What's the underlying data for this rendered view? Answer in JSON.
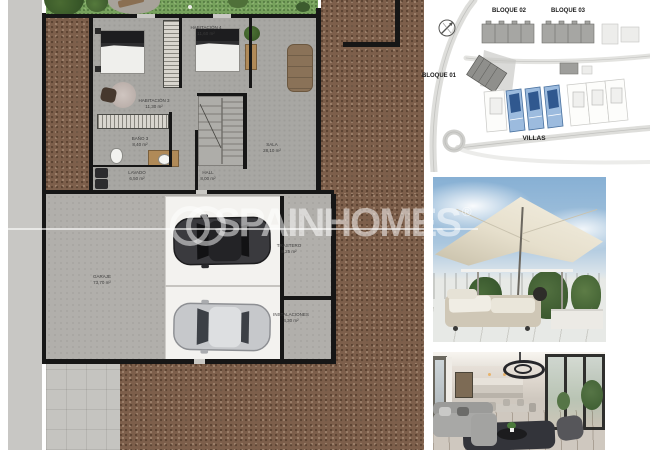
{
  "watermark": {
    "brand": "SPAINHOMES",
    "registered_symbol": "®"
  },
  "floor_plan": {
    "rooms": [
      {
        "name": "HABITACIÓN 3",
        "area": "11,30 m²"
      },
      {
        "name": "HABITACIÓN 4",
        "area": "11,60 m²"
      },
      {
        "name": "BAÑO 3",
        "area": "8,40 m²"
      },
      {
        "name": "LAVADO",
        "area": "6,50 m²"
      },
      {
        "name": "HALL",
        "area": "8,00 m²"
      },
      {
        "name": "SALA",
        "area": "28,10 m²"
      },
      {
        "name": "GARAJE",
        "area": "73,70 m²"
      },
      {
        "name": "TRASTERO",
        "area": "8,25 m²"
      },
      {
        "name": "INSTALACIONES",
        "area": "4,30 m²"
      }
    ]
  },
  "site_plan": {
    "labels": {
      "bloque_01": "BLOQUE 01",
      "bloque_02": "BLOQUE 02",
      "bloque_03": "BLOQUE 03",
      "villas": "VILLAS"
    },
    "highlighted_units": 3
  },
  "colors": {
    "soil": "#7d5f4b",
    "grass": "#77a25d",
    "interior_floor": "#a8a7a3",
    "wall": "#161616",
    "villa_highlight_fill": "#9cbbde",
    "villa_highlight_roof": "#30588f",
    "sky": "#87b0d4",
    "umbrella": "#efe9da"
  }
}
